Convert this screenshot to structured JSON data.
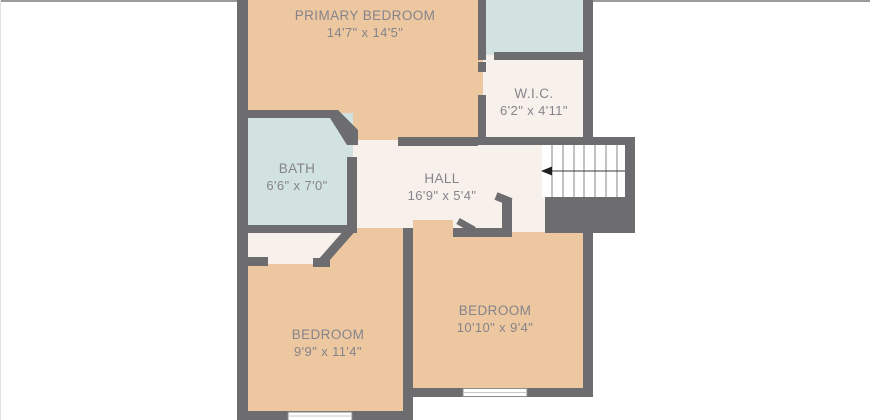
{
  "image_type": "second-floor floor plan",
  "colors": {
    "background": "#ffffff",
    "border_top": "#9b9b9b",
    "wall": "#6d6d6f",
    "floor_bedroom": "#edc7a0",
    "floor_bath": "#d2e2e0",
    "floor_hall": "#f8f0eb",
    "stair_fill": "#ffffff",
    "label_text": "#85848b"
  },
  "rooms": [
    {
      "id": "primary-bedroom",
      "name": "PRIMARY BEDROOM",
      "dimensions": "14'7\" x 14'5\""
    },
    {
      "id": "wic",
      "name": "W.I.C.",
      "dimensions": "6'2\" x 4'11\""
    },
    {
      "id": "bath",
      "name": "BATH",
      "dimensions": "6'6\" x 7'0\""
    },
    {
      "id": "hall",
      "name": "HALL",
      "dimensions": "16'9\" x 5'4\""
    },
    {
      "id": "bedroom-left",
      "name": "BEDROOM",
      "dimensions": "9'9\" x 11'4\""
    },
    {
      "id": "bedroom-right",
      "name": "BEDROOM",
      "dimensions": "10'10\" x 9'4\""
    }
  ],
  "stairs": {
    "tread_count": 8,
    "arrow_direction": "left"
  },
  "window_count": 2
}
